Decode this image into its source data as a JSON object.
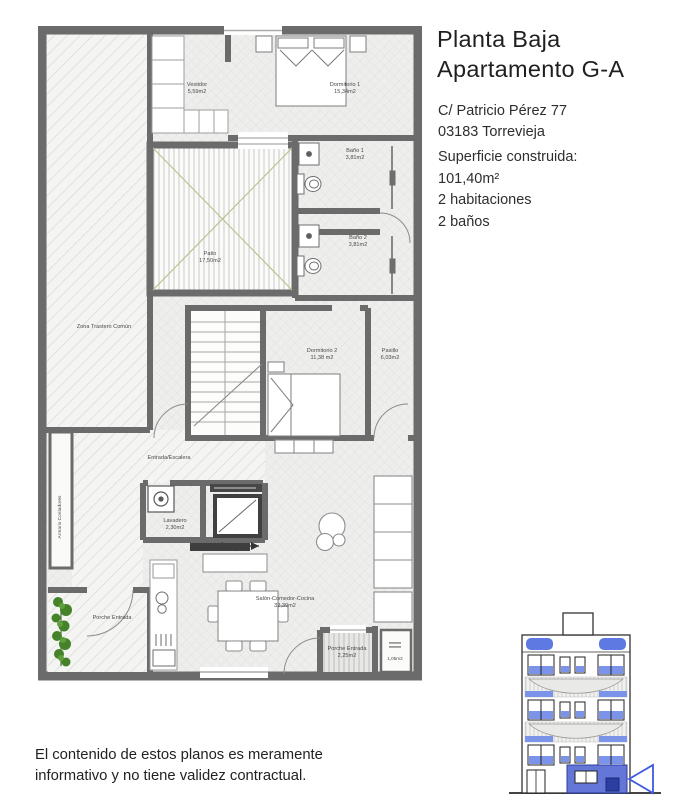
{
  "header": {
    "title_line1": "Planta Baja",
    "title_line2": "Apartamento G-A",
    "address_line1": "C/ Patricio Pérez 77",
    "address_line2": "03183 Torrevieja",
    "surface_label": "Superficie construida:",
    "surface_value": "101,40m²",
    "habitaciones": "2 habitaciones",
    "banos": "2 baños"
  },
  "floorplan": {
    "rooms": {
      "vestidor": {
        "name": "Vestidor",
        "area": "5,59m2"
      },
      "dormitorio1": {
        "name": "Dormitorio 1",
        "area": "15,34m2"
      },
      "bano1": {
        "name": "Baño 1",
        "area": "3,81m2"
      },
      "bano2": {
        "name": "Baño 2",
        "area": "3,81m2"
      },
      "patio": {
        "name": "Patio",
        "area": "17,50m2"
      },
      "zona_trastero": {
        "name": "Zona Trastero Común"
      },
      "dormitorio2": {
        "name": "Dormitorio 2",
        "area": "11,38 m2"
      },
      "pasillo": {
        "name": "Pasillo",
        "area": "6,03m2"
      },
      "entrada": {
        "name": "Entrada/Escalera"
      },
      "armario_contadores": {
        "name": "Armario Contadores"
      },
      "lavadero": {
        "name": "Lavadero",
        "area": "2,30m2"
      },
      "salon": {
        "name": "Salón-Comedor-Cocina",
        "area": "32,39m2"
      },
      "porche_izq": {
        "name": "Porche Entrada"
      },
      "porche_der": {
        "name": "Porche Entrada",
        "area": "2,25m2"
      },
      "armario_porche": {
        "area": "1,05m2"
      }
    }
  },
  "footer": {
    "disclaimer_line1": "El contenido de estos planos es meramente",
    "disclaimer_line2": "informativo y no tiene validez contractual."
  },
  "colors": {
    "wall_grey": "#6b6b6b",
    "floor_grey": "#ededec",
    "accent_blue": "#5d7ae3",
    "highlight_blue": "#4f63d2",
    "plant_green": "#458229",
    "patio_green": "#b5c490"
  }
}
